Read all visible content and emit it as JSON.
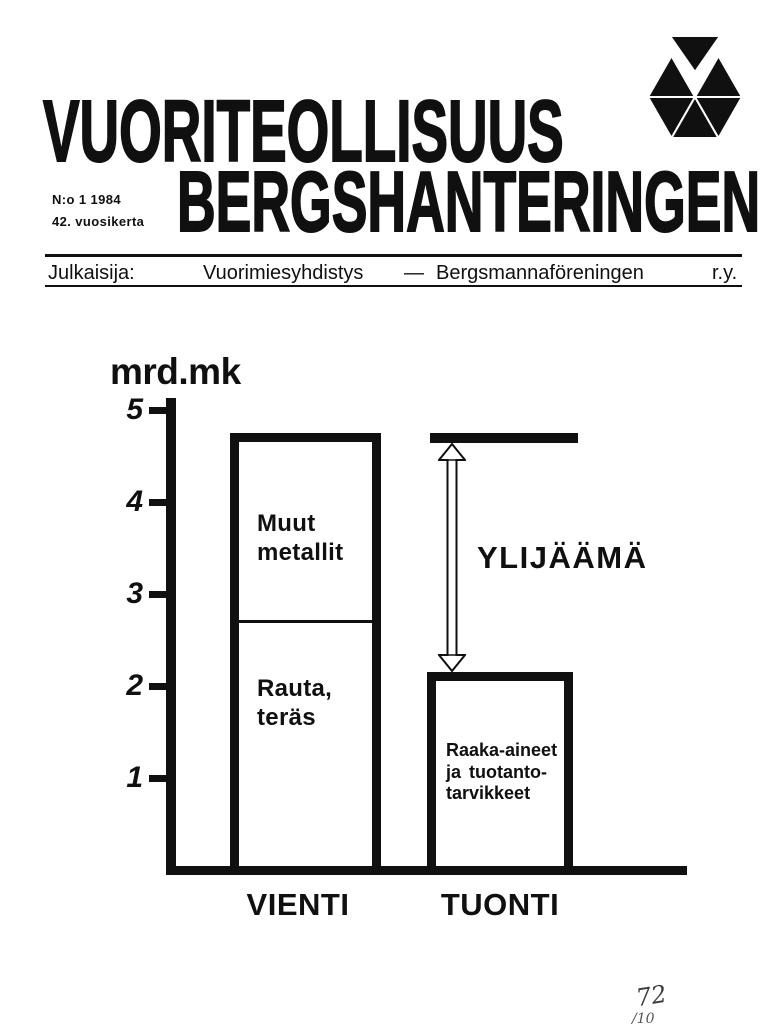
{
  "masthead": {
    "title_line1": "VUORITEOLLISUUS",
    "title_line2": "BERGSHANTERINGEN",
    "issue_number": "N:o 1 1984",
    "volume": "42. vuosikerta",
    "logo_icon": "triangle-hexagon-mining-emblem"
  },
  "publisher_bar": {
    "label": "Julkaisija:",
    "name_fi": "Vuorimiesyhdistys",
    "separator": "—",
    "name_sv": "Bergsmannaföreningen",
    "suffix": "r.y."
  },
  "chart_data": {
    "type": "bar",
    "unit_label": "mrd.mk",
    "ylabel": "mrd.mk",
    "xlabel": "",
    "ylim": [
      0,
      5
    ],
    "yticks": [
      5,
      4,
      3,
      2,
      1
    ],
    "grid": false,
    "categories": [
      "VIENTI",
      "TUONTI"
    ],
    "series": [
      {
        "name": "Rauta, teräs",
        "category": "VIENTI",
        "value": 2.7
      },
      {
        "name": "Muut metallit",
        "category": "VIENTI",
        "value": 2.0
      },
      {
        "name": "Raaka-aineet ja tuotantotarvikkeet",
        "category": "TUONTI",
        "value": 2.1
      }
    ],
    "vienti": {
      "total": 4.7,
      "divider_value": 2.7,
      "upper_segment_lines": [
        "Muut",
        "metallit"
      ],
      "lower_segment_lines": [
        "Rauta,",
        "teräs"
      ]
    },
    "tuonti": {
      "total": 2.1,
      "label_lines": [
        "Raaka-aineet",
        "ja tuotanto-",
        "tarvikkeet"
      ]
    },
    "reference_line": {
      "value": 4.7
    },
    "annotation": {
      "label": "YLIJÄÄMÄ",
      "value": 2.6
    }
  },
  "handwriting": {
    "line1": "72",
    "line2": "/10"
  },
  "colors": {
    "ink": "#101010",
    "paper": "#ffffff"
  }
}
